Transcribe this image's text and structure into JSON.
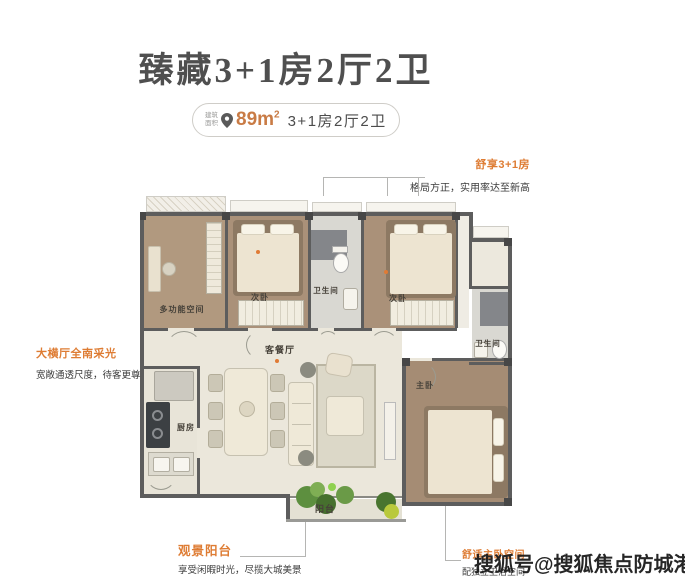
{
  "title": "臻藏3+1房2厅2卫",
  "badge": {
    "area_caption_top": "建筑",
    "area_caption_bottom": "面积",
    "pin_icon": "location-pin",
    "area_value": "89m",
    "area_superscript": "2",
    "layout_text": "3+1房2厅2卫"
  },
  "annotations": {
    "top_right": {
      "title": "舒享3+1房",
      "desc": "格局方正，实用率达至新高"
    },
    "left": {
      "title": "大横厅全南采光",
      "desc": "宽敞通透尺度，待客更尊崇"
    },
    "bottom_left": {
      "title": "观景阳台",
      "desc": "享受闲暇时光，尽揽大城美景"
    },
    "bottom_right": {
      "title": "舒适主卧空间",
      "desc": "配独立卫浴空间"
    }
  },
  "floorplan": {
    "rooms": [
      {
        "id": "multifunction-room",
        "label": "多功能空间"
      },
      {
        "id": "bedroom-2",
        "label": "次卧"
      },
      {
        "id": "bathroom-1",
        "label": "卫生间"
      },
      {
        "id": "bedroom-3",
        "label": "次卧"
      },
      {
        "id": "bathroom-2",
        "label": "卫生间"
      },
      {
        "id": "living-dining",
        "label": "客餐厅"
      },
      {
        "id": "kitchen",
        "label": "厨房"
      },
      {
        "id": "master-bedroom",
        "label": "主卧"
      },
      {
        "id": "balcony",
        "label": "阳台"
      }
    ]
  },
  "watermark": "搜狐号@搜狐焦点防城港站",
  "colors": {
    "accent_orange": "#de7c33",
    "area_value_orange": "#c97b45",
    "title_gray": "#4f4f4f",
    "text_dark": "#3c3c3c",
    "wall_gray": "#5d5d5d",
    "wood_floor": "#ab9279",
    "watermark_dark": "#1a1a1a"
  }
}
